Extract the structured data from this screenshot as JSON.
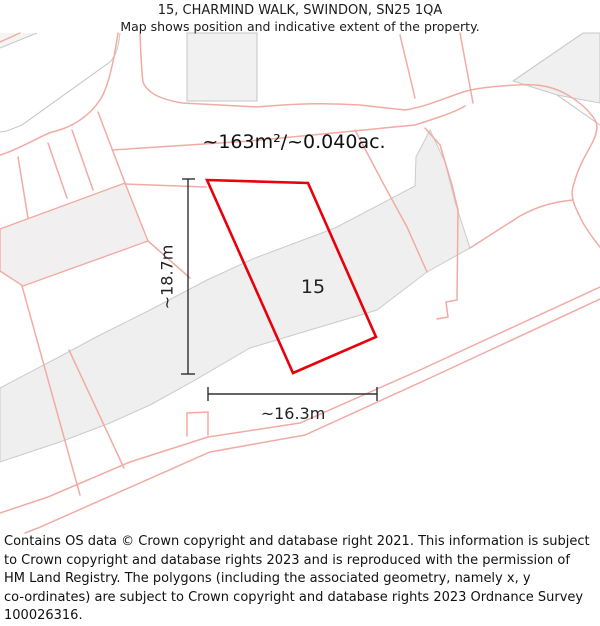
{
  "title": {
    "line1": "15, CHARMIND WALK, SWINDON, SN25 1QA",
    "line2": "Map shows position and indicative extent of the property."
  },
  "map": {
    "area_label": "~163m²/~0.040ac.",
    "plot_number": "15",
    "dim_vertical": "~18.7m",
    "dim_horizontal": "~16.3m",
    "colors": {
      "property_outline": "#e8000b",
      "parcel_line": "#f2aba4",
      "building_fill": "#f0efef",
      "building_stroke": "#c9c9c9",
      "road_band_fill": "#efefef",
      "dimension_line": "#303030"
    }
  },
  "footer": {
    "lines": [
      "Contains OS data © Crown copyright and database right 2021. This information is subject",
      "to Crown copyright and database rights 2023 and is reproduced with the permission of",
      "HM Land Registry. The polygons (including the associated geometry, namely x, y",
      "co-ordinates) are subject to Crown copyright and database rights 2023 Ordnance Survey",
      "100026316."
    ]
  }
}
